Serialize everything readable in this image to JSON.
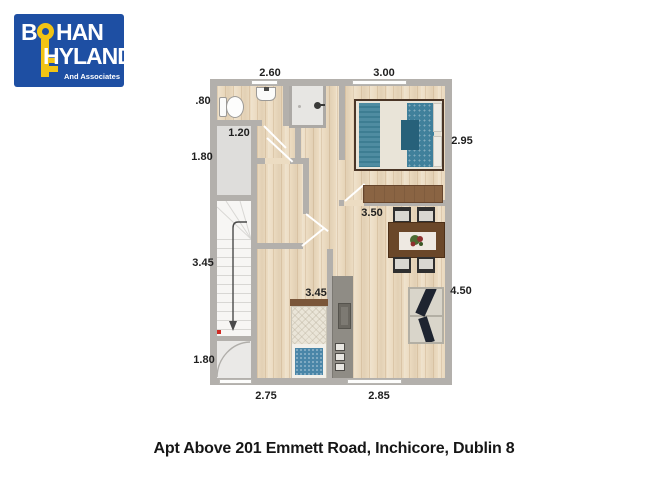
{
  "logo": {
    "word1_start": "B",
    "word1_end": "HAN",
    "word2": "HYLAND",
    "tagline": "And Associates",
    "brand_blue": "#1e4fa3",
    "key_yellow": "#f2c414"
  },
  "plan": {
    "dimensions": {
      "top_left": "2.60",
      "top_right": "3.00",
      "bath_left": ".80",
      "closet_width": "1.20",
      "closet_height": "1.80",
      "bedroom1_height": "2.95",
      "living_width": "3.50",
      "stairs_height": "3.45",
      "bedroom2_length": "3.45",
      "living_height": "4.50",
      "entry_height": "1.80",
      "bottom_left": "2.75",
      "bottom_right": "2.85"
    },
    "colors": {
      "wall_gray": "#b3b0ac",
      "floor_wood": "#ecdcc2",
      "bed_teal": "#4a86a1",
      "pillow_teal": "#40809b",
      "wardrobe_brown": "#8a6443",
      "table_brown": "#6a4729",
      "counter_gray": "#8f8c85",
      "sofa_navy": "#1e2430"
    }
  },
  "caption": "Apt Above 201 Emmett Road, Inchicore, Dublin 8"
}
